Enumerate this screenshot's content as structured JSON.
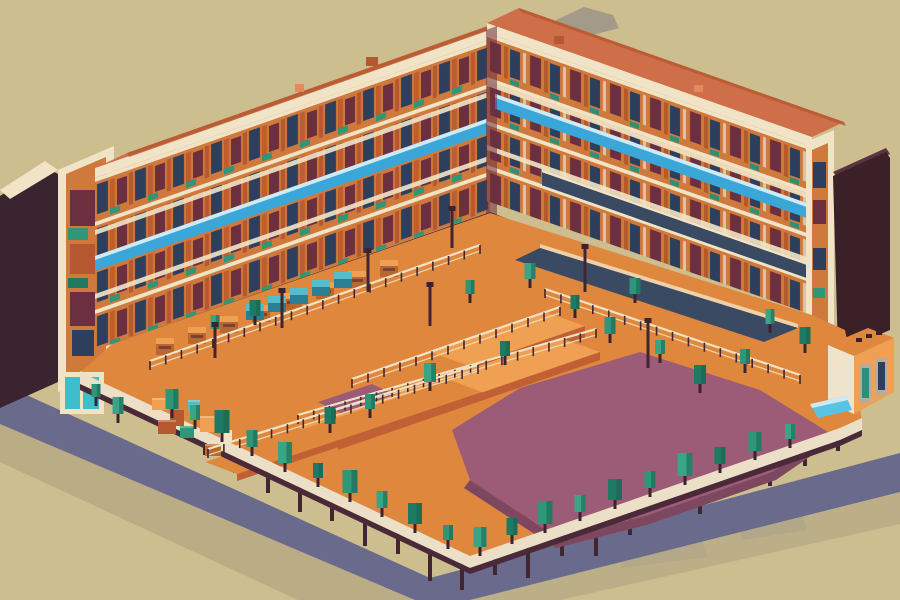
{
  "scene": {
    "description": "Isometric pixel-art illustration of an L-shaped orange apartment complex wrapping a courtyard plaza with a purple floor, teal trees, market stalls, railed terraces on stilts, dark tower slabs at the left and right edges, and a blue-gray ground shadow on a tan background.",
    "style": "isometric-pixel-art",
    "palette": {
      "background": "#cdbe8f",
      "smudge": "#9b948a",
      "smudge_soft": "#b6ac93",
      "shadow_band": "#6a6a8c",
      "shadow_soft": "#8e8672",
      "slab_dark": "#3a2430",
      "slab_dark2": "#3b2028",
      "slab_highlight": "#5a3242",
      "cream": "#f1e4c6",
      "cream_dark": "#d9c8a8",
      "roof_salmon": "#cf6f4a",
      "roof_salmon_light": "#e08a5e",
      "facade_orange": "#d0793c",
      "facade_orange_dark": "#b5572f",
      "pier_shade": "#c05c30",
      "window_navy": "#2e3f5e",
      "window_maroon": "#6b2f40",
      "window_teal": "#2b8f7a",
      "awning_blue": "#3ba7d8",
      "awning_blue_light": "#cfeaf4",
      "storefront_dark": "#492631",
      "terrace_orange": "#e0873e",
      "terrace_orange_light": "#f0a052",
      "terrace_orange_deep": "#c06034",
      "walkway_cream": "#eee1c3",
      "walkway_navy": "#3a4a63",
      "courtyard_purple": "#9c5b77",
      "courtyard_purple_dark": "#7e4760",
      "tree_teal": "#2f9678",
      "tree_teal2": "#3aa585",
      "tree_teal_dark": "#1f7a63",
      "tree_shade": "#176353",
      "trunk": "#3a2430",
      "stall_brown": "#b9672e",
      "box_cyan_top": "#55bccb",
      "box_cyan_side": "#2b7f92",
      "post_dark": "#402630",
      "rim_cream": "#ebdfc7",
      "rim_beam": "#4a2a38",
      "glass_teal": "#3fbdc8",
      "water_blue": "#58c4e4",
      "kiosk_cream": "#efe3cc",
      "door_tan": "#bcab94"
    },
    "trees": [
      [
        172,
        409,
        13,
        20,
        0
      ],
      [
        195,
        420,
        10,
        15,
        1
      ],
      [
        222,
        433,
        15,
        23,
        2
      ],
      [
        252,
        447,
        11,
        17,
        0
      ],
      [
        285,
        463,
        14,
        21,
        1
      ],
      [
        318,
        478,
        10,
        15,
        2
      ],
      [
        350,
        493,
        15,
        23,
        0
      ],
      [
        382,
        508,
        11,
        17,
        1
      ],
      [
        415,
        524,
        14,
        21,
        2
      ],
      [
        448,
        540,
        10,
        15,
        0
      ],
      [
        480,
        547,
        13,
        20,
        1
      ],
      [
        512,
        535,
        11,
        17,
        2
      ],
      [
        545,
        524,
        15,
        23,
        0
      ],
      [
        580,
        512,
        11,
        17,
        1
      ],
      [
        615,
        500,
        14,
        21,
        2
      ],
      [
        650,
        488,
        11,
        17,
        0
      ],
      [
        685,
        476,
        15,
        23,
        1
      ],
      [
        720,
        464,
        11,
        17,
        2
      ],
      [
        755,
        451,
        13,
        19,
        0
      ],
      [
        790,
        439,
        10,
        15,
        1
      ],
      [
        330,
        424,
        11,
        17,
        2
      ],
      [
        370,
        409,
        10,
        15,
        0
      ],
      [
        430,
        382,
        12,
        19,
        1
      ],
      [
        505,
        356,
        10,
        15,
        2
      ],
      [
        610,
        334,
        11,
        17,
        0
      ],
      [
        660,
        354,
        10,
        14,
        1
      ],
      [
        700,
        384,
        12,
        19,
        2
      ],
      [
        745,
        364,
        10,
        15,
        0
      ],
      [
        215,
        329,
        9,
        14,
        1
      ],
      [
        255,
        316,
        11,
        16,
        2
      ],
      [
        470,
        294,
        9,
        14,
        0
      ],
      [
        530,
        279,
        11,
        16,
        1
      ],
      [
        575,
        309,
        9,
        14,
        2
      ],
      [
        635,
        294,
        11,
        16,
        0
      ],
      [
        770,
        324,
        9,
        15,
        1
      ],
      [
        805,
        344,
        11,
        17,
        2
      ],
      [
        118,
        414,
        11,
        17,
        1
      ],
      [
        96,
        397,
        9,
        13,
        0
      ]
    ],
    "stilts": [
      [
        205,
        431,
        24
      ],
      [
        235,
        445,
        28
      ],
      [
        268,
        461,
        32
      ],
      [
        300,
        476,
        36
      ],
      [
        332,
        491,
        30
      ],
      [
        365,
        506,
        40
      ],
      [
        398,
        522,
        32
      ],
      [
        430,
        537,
        44
      ],
      [
        462,
        552,
        38
      ],
      [
        495,
        547,
        28
      ],
      [
        528,
        536,
        42
      ],
      [
        562,
        524,
        32
      ],
      [
        596,
        512,
        44
      ],
      [
        630,
        501,
        34
      ],
      [
        665,
        489,
        28
      ],
      [
        700,
        476,
        38
      ],
      [
        735,
        464,
        28
      ],
      [
        770,
        452,
        34
      ],
      [
        805,
        440,
        26
      ],
      [
        838,
        429,
        22
      ]
    ],
    "stalls": [
      [
        165,
        352
      ],
      [
        197,
        341
      ],
      [
        229,
        330
      ],
      [
        261,
        319
      ],
      [
        293,
        307
      ],
      [
        325,
        296
      ],
      [
        357,
        285
      ],
      [
        389,
        274
      ]
    ],
    "cyan_boxes": [
      [
        255,
        316
      ],
      [
        277,
        308
      ],
      [
        299,
        300
      ],
      [
        321,
        292
      ],
      [
        343,
        284
      ]
    ],
    "crates": [
      [
        152,
        398,
        16,
        12,
        "terrace_orange_light"
      ],
      [
        170,
        408,
        14,
        18,
        "facade_orange_dark"
      ],
      [
        188,
        400,
        12,
        10,
        "box_cyan_top"
      ],
      [
        158,
        420,
        18,
        14,
        "facade_orange_dark"
      ],
      [
        180,
        426,
        14,
        12,
        "tree_teal"
      ],
      [
        200,
        416,
        16,
        16,
        "terrace_orange_light"
      ],
      [
        220,
        430,
        12,
        12,
        "cream"
      ],
      [
        205,
        444,
        16,
        12,
        "stall_brown"
      ]
    ],
    "railings": [
      [
        150,
        370,
        480,
        254
      ],
      [
        298,
        424,
        596,
        338
      ],
      [
        208,
        458,
        478,
        374
      ],
      [
        545,
        298,
        800,
        384
      ],
      [
        352,
        388,
        560,
        316
      ]
    ],
    "poles": [
      [
        368,
        292,
        40
      ],
      [
        452,
        248,
        38
      ],
      [
        282,
        328,
        36
      ],
      [
        585,
        292,
        44
      ],
      [
        648,
        368,
        46
      ],
      [
        215,
        358,
        32
      ],
      [
        430,
        326,
        40
      ]
    ]
  }
}
